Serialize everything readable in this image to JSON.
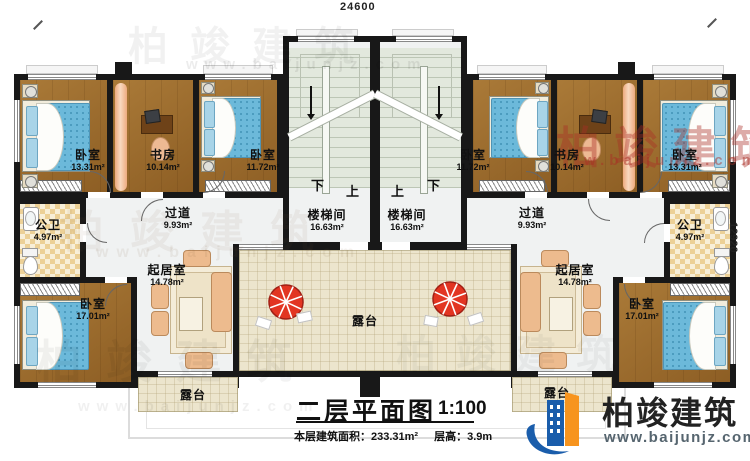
{
  "dimensions": {
    "top": "24600",
    "right": "12920"
  },
  "title": {
    "main": "二层平面图",
    "scale": "1:100",
    "area_label": "本层建筑面积：",
    "area_value": "233.31m²",
    "floor_height_label": "层高：",
    "floor_height_value": "3.9m"
  },
  "brand": {
    "name": "柏竣建筑",
    "site": "www.baijunjz.com"
  },
  "watermark": {
    "text": "柏竣建筑",
    "site": "www.baijunjz.com",
    "site_short": "w.baijunjz.com"
  },
  "stairs": {
    "down": "下",
    "up": "上"
  },
  "rooms": {
    "bedroom_13": {
      "name": "卧室",
      "area": "13.31m²"
    },
    "study": {
      "name": "书房",
      "area": "10.14m²"
    },
    "bedroom_11": {
      "name": "卧室",
      "area": "11.72m²"
    },
    "corridor": {
      "name": "过道",
      "area": "9.93m²"
    },
    "stairwell": {
      "name": "楼梯间",
      "area": "16.63m²"
    },
    "bath": {
      "name": "公卫",
      "area": "4.97m²"
    },
    "living": {
      "name": "起居室",
      "area": "14.78m²"
    },
    "bedroom_17": {
      "name": "卧室",
      "area": "17.01m²"
    },
    "terrace": {
      "name": "露台"
    }
  },
  "colors": {
    "wall": "#1a1a1a",
    "wood_floor": "#9c6b2c",
    "mattress_blue": "#6ab5d8",
    "umbrella_red": "#e23522",
    "logo_blue": "#1a5dab",
    "logo_orange": "#f7941e"
  }
}
